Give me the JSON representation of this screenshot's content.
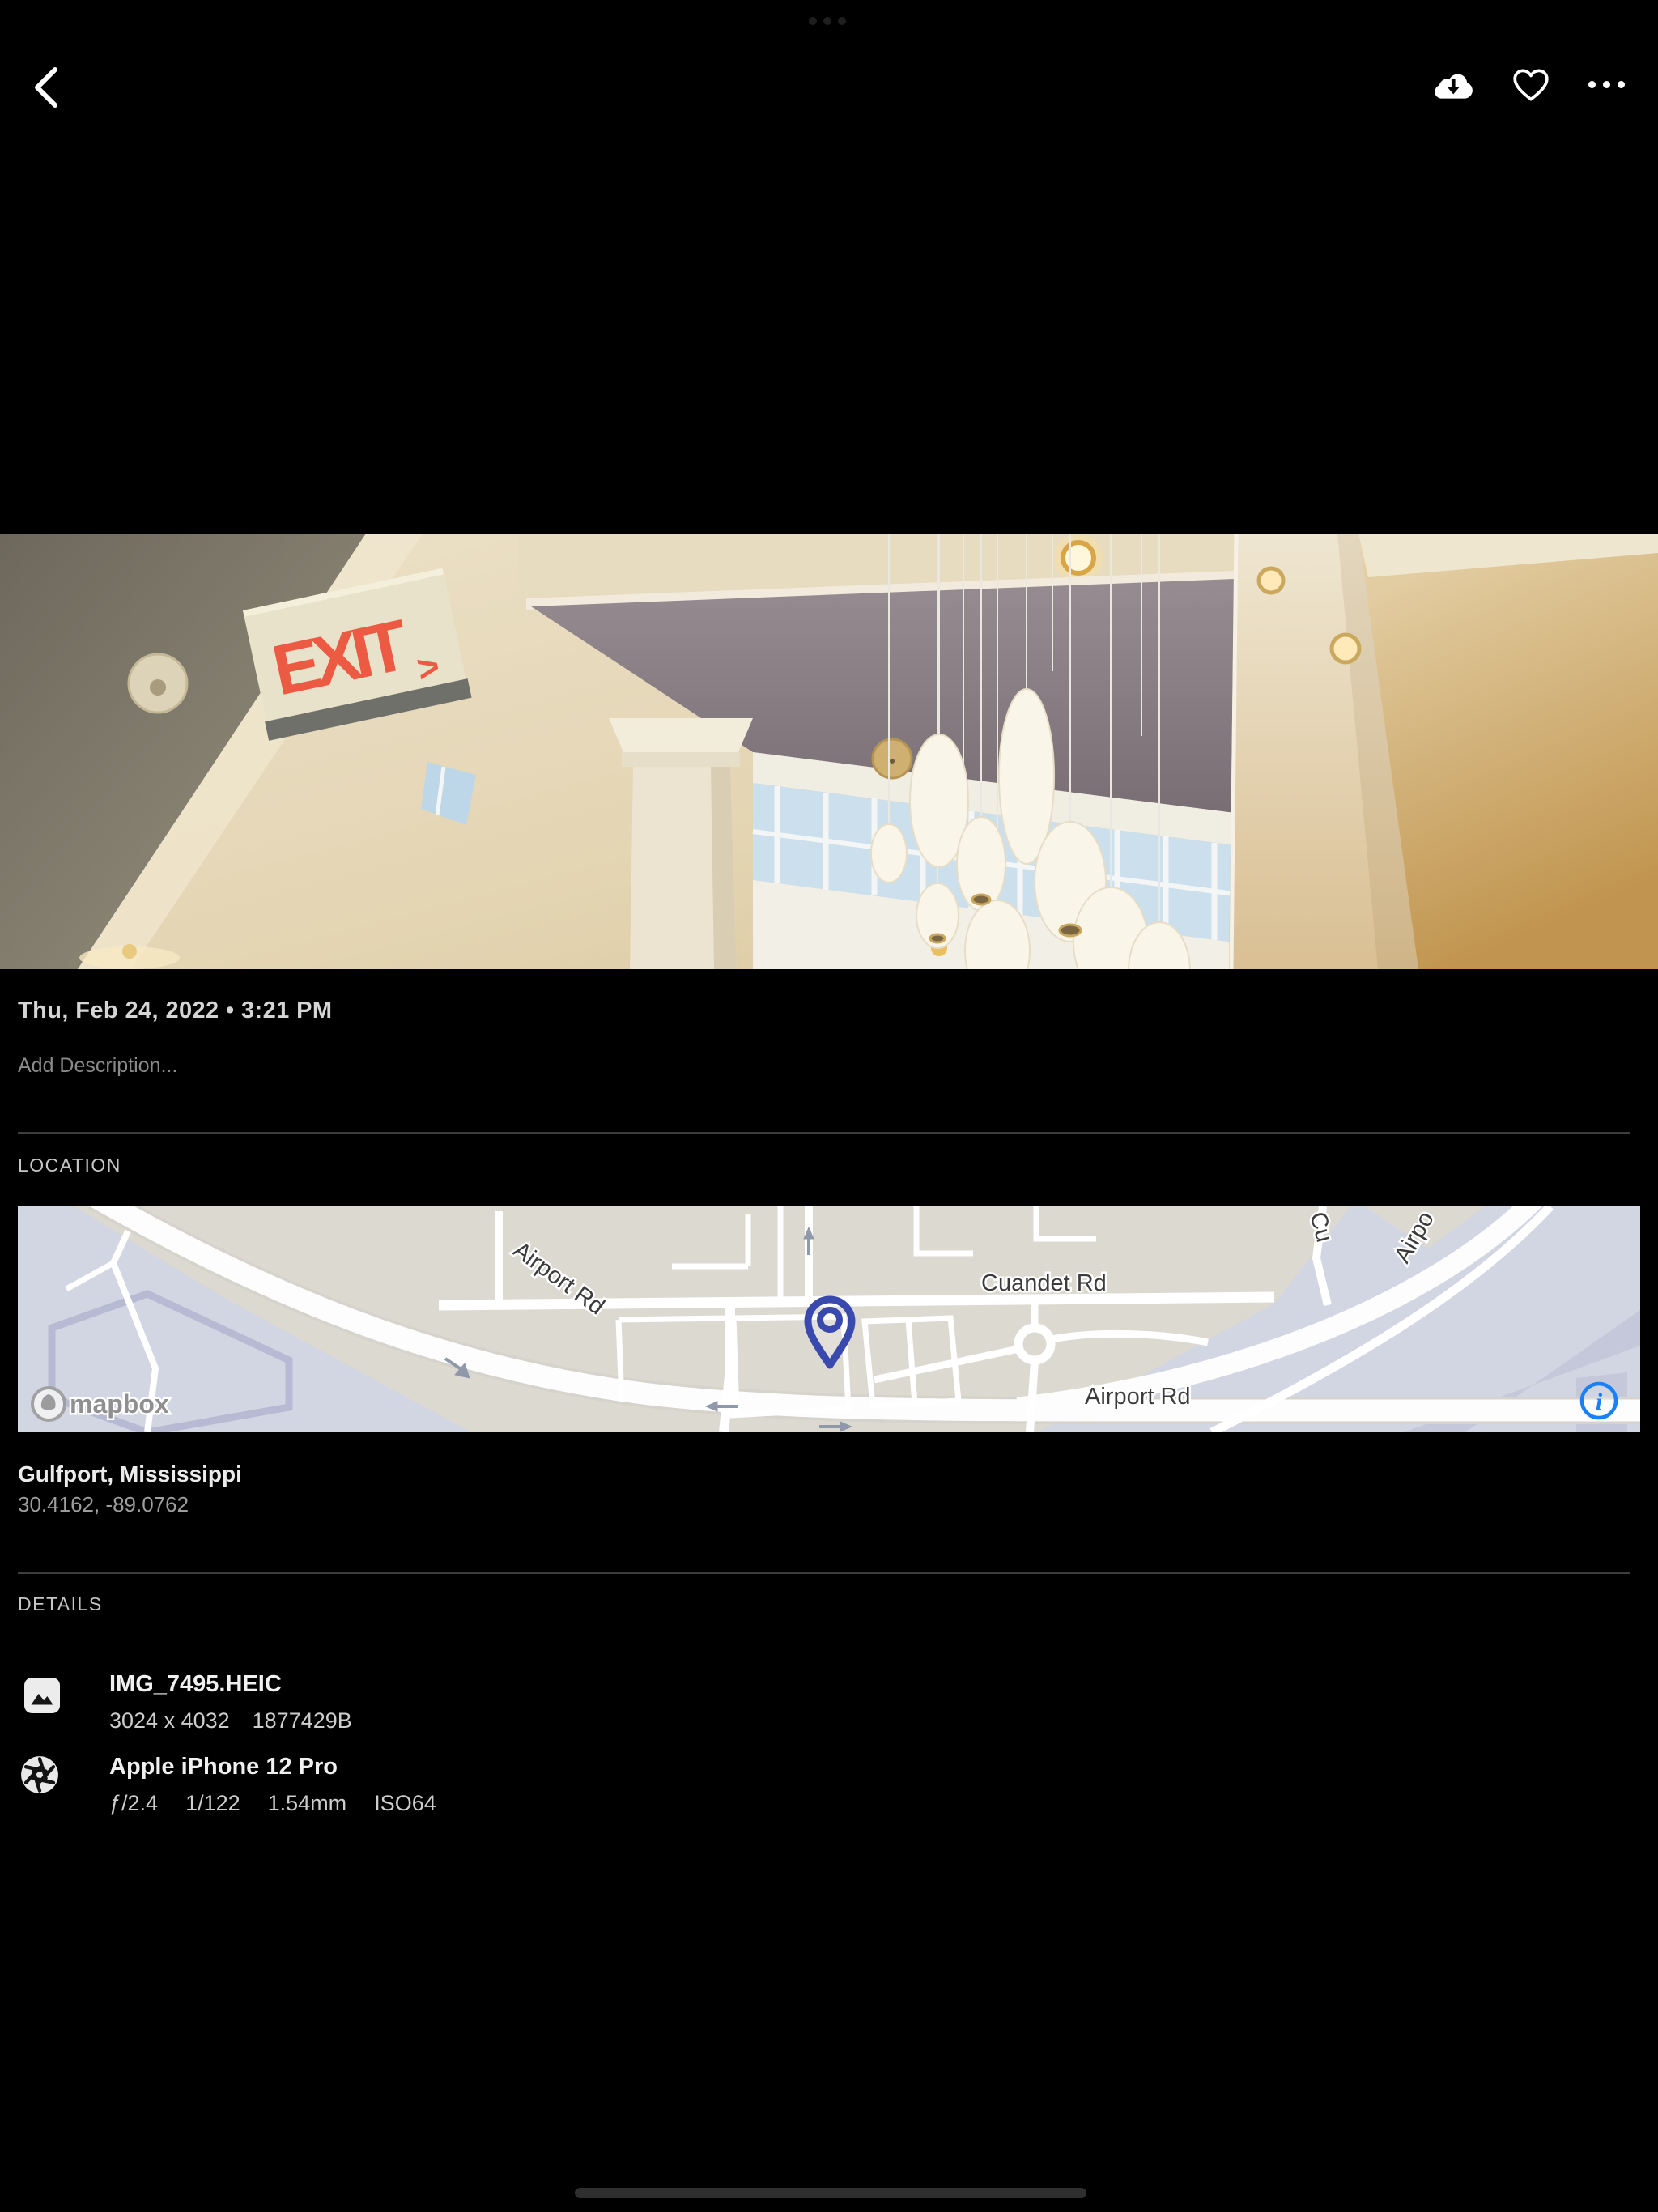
{
  "top_bar": {
    "icons": {
      "back": "chevron-left",
      "download": "cloud-download",
      "favorite": "heart-outline",
      "more": "ellipsis-horizontal",
      "app_switcher": "three-dots"
    }
  },
  "photo": {
    "exit_sign": {
      "text": "EXIT",
      "arrow": ">"
    }
  },
  "info": {
    "date_line": "Thu, Feb 24, 2022 • 3:21 PM",
    "description_placeholder": "Add Description..."
  },
  "location": {
    "section_label": "LOCATION",
    "place": "Gulfport, Mississippi",
    "coordinates": "30.4162, -89.0762",
    "map": {
      "labels": {
        "airport_rd_diagonal": "Airport Rd",
        "cuandet_rd": "Cuandet Rd",
        "airport_rd_horizontal": "Airport Rd",
        "cu_partial": "Cu",
        "airpo_partial": "Airpo"
      },
      "attribution": "mapbox",
      "info_glyph": "i",
      "colors": {
        "land": "#dcd9d1",
        "water": "#d2d5e2",
        "road": "#ffffff",
        "pin": "#3a49ae",
        "info_blue": "#1a80f5"
      }
    }
  },
  "details": {
    "section_label": "DETAILS",
    "file": {
      "name": "IMG_7495.HEIC",
      "dimensions": "3024 x 4032",
      "size": "1877429B"
    },
    "camera": {
      "name": "Apple iPhone 12 Pro",
      "aperture": "ƒ/2.4",
      "shutter_speed": "1/122",
      "focal_length": "1.54mm",
      "iso": "ISO64"
    }
  },
  "colors": {
    "background": "#000000",
    "text_primary": "#f0f0f0",
    "text_secondary": "#9d9d9d",
    "section_label": "#c6c6c6",
    "exit_red": "#ed5a43"
  }
}
